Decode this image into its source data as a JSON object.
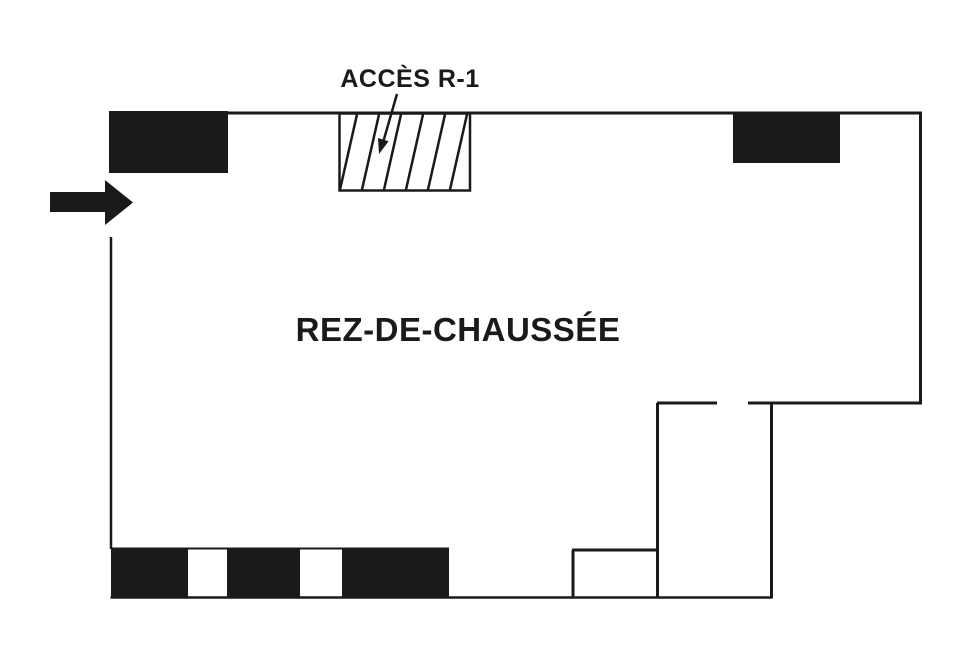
{
  "plan": {
    "access_label": "ACCÈS R-1",
    "floor_label": "REZ-DE-CHAUSSÉE",
    "colors": {
      "ink": "#1a1a1a",
      "paper": "#ffffff"
    }
  }
}
